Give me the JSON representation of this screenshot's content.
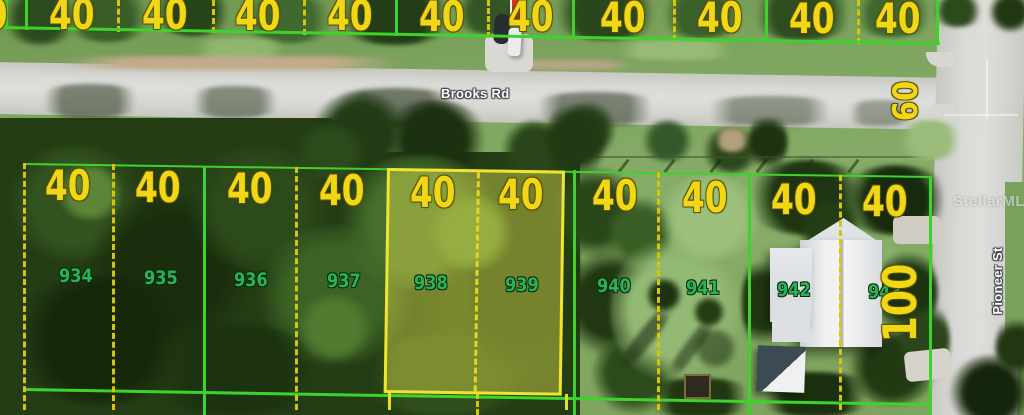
{
  "map": {
    "streets": {
      "brooks": "Brooks Rd",
      "pioneer": "Pioneer St"
    },
    "watermark": "StellarMLS",
    "dimension_labels": {
      "lot_width": "40",
      "corner_side": "60",
      "lot_depth": "100"
    },
    "top_row": {
      "partial_label": "40",
      "width_labels": [
        "40",
        "40",
        "40",
        "40",
        "40",
        "40",
        "40",
        "40",
        "40",
        "40"
      ]
    },
    "bottom_row": {
      "width_labels": [
        "40",
        "40",
        "40",
        "40",
        "40",
        "40",
        "40",
        "40",
        "40",
        "40"
      ],
      "lot_numbers": [
        "934",
        "935",
        "936",
        "937",
        "938",
        "939",
        "940",
        "941",
        "942",
        "943"
      ],
      "highlighted_lot_numbers": [
        "938",
        "939"
      ]
    },
    "colors": {
      "parcel_line_green": "#3ed32b",
      "parcel_dash_yellow": "#d9c40a",
      "width_label_yellow": "#f2d716",
      "lot_number_green": "#2bb257",
      "highlight_border": "#eee431",
      "highlight_fill": "rgba(232,228,80,0.42)",
      "street_label": "#ffffff",
      "marker_red": "#dd3427"
    }
  }
}
